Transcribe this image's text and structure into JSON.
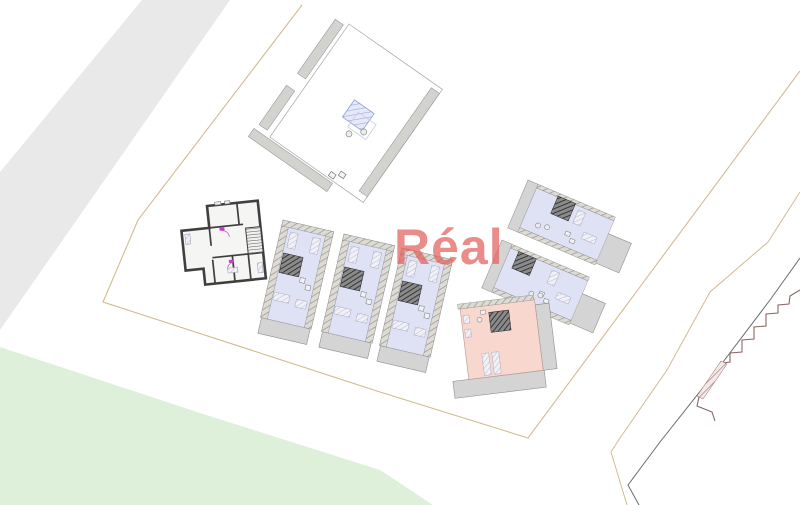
{
  "watermark": {
    "text": "Réal",
    "color": "#e2605c"
  },
  "palette": {
    "background": "#ffffff",
    "road": "#e9e9e9",
    "lawn": "#def0d9",
    "boundary": "#d2bb92",
    "contour": "#6a6a72",
    "steps": "#8c6464",
    "unit_blue": "#dfe1f4",
    "unit_pink": "#f8d7cf",
    "terrace_gray": "#d4d4d4",
    "wall_gray": "#d2d2cf",
    "house_wall_dark": "#3f3f3f",
    "door_magenta": "#c93ec9",
    "stair_blue_outline": "#8e9fd6"
  }
}
